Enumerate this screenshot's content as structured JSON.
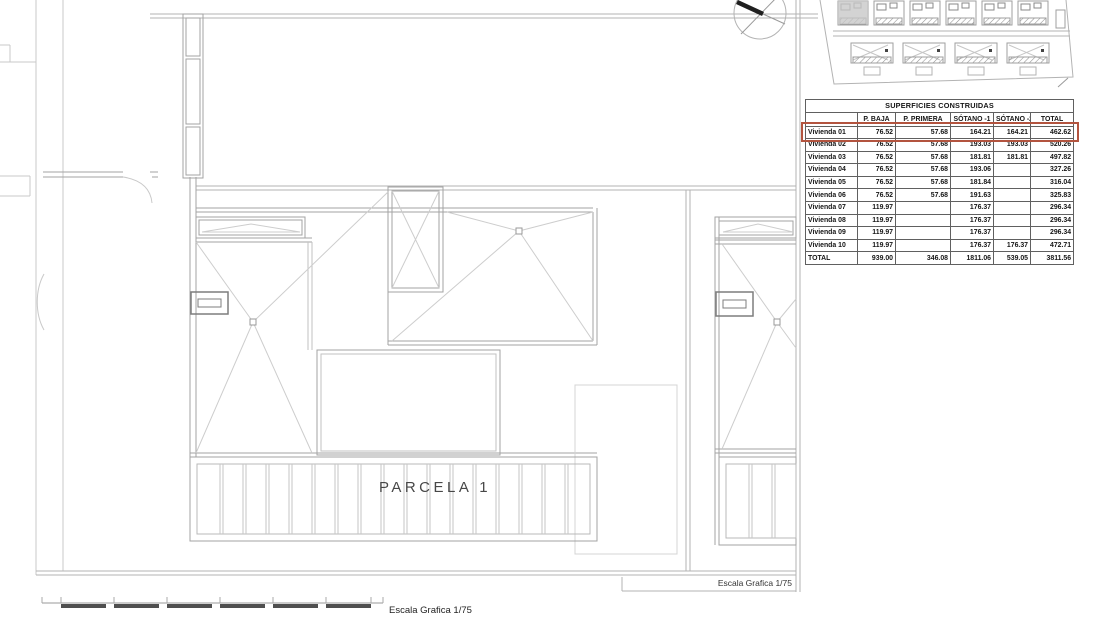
{
  "document": {
    "type": "architectural-roof-plan",
    "parcel_label": "PARCELA 1",
    "scale_label_frame": "Escala Grafica 1/75",
    "scale_label_bar": "Escala Grafica 1/75"
  },
  "table": {
    "title": "SUPERFICIES CONSTRUIDAS",
    "columns": [
      "",
      "P. BAJA",
      "P. PRIMERA",
      "SÓTANO -1",
      "SÓTANO -2",
      "TOTAL"
    ],
    "rows": [
      {
        "label": "Vivienda 01",
        "values": [
          "76.52",
          "57.68",
          "164.21",
          "164.21",
          "462.62"
        ],
        "highlighted": true
      },
      {
        "label": "Vivienda 02",
        "values": [
          "76.52",
          "57.68",
          "193.03",
          "193.03",
          "520.26"
        ]
      },
      {
        "label": "Vivienda 03",
        "values": [
          "76.52",
          "57.68",
          "181.81",
          "181.81",
          "497.82"
        ]
      },
      {
        "label": "Vivienda 04",
        "values": [
          "76.52",
          "57.68",
          "193.06",
          "",
          "327.26"
        ]
      },
      {
        "label": "Vivienda 05",
        "values": [
          "76.52",
          "57.68",
          "181.84",
          "",
          "316.04"
        ]
      },
      {
        "label": "Vivienda 06",
        "values": [
          "76.52",
          "57.68",
          "191.63",
          "",
          "325.83"
        ]
      },
      {
        "label": "Vivienda 07",
        "values": [
          "119.97",
          "",
          "176.37",
          "",
          "296.34"
        ]
      },
      {
        "label": "Vivienda 08",
        "values": [
          "119.97",
          "",
          "176.37",
          "",
          "296.34"
        ]
      },
      {
        "label": "Vivienda 09",
        "values": [
          "119.97",
          "",
          "176.37",
          "",
          "296.34"
        ]
      },
      {
        "label": "Vivienda 10",
        "values": [
          "119.97",
          "",
          "176.37",
          "176.37",
          "472.71"
        ]
      },
      {
        "label": "TOTAL",
        "values": [
          "939.00",
          "346.08",
          "1811.06",
          "539.05",
          "3811.56"
        ],
        "is_total": true
      }
    ],
    "highlight_color": "#b3543f"
  },
  "colors": {
    "background": "#ffffff",
    "line_light": "#c9c9c9",
    "line_mid": "#b3b3b3",
    "line_dark": "#8c8c8c",
    "table_border": "#606060",
    "text": "#151515",
    "highlight": "#b3543f",
    "shaded_unit": "#c6c6c6"
  }
}
